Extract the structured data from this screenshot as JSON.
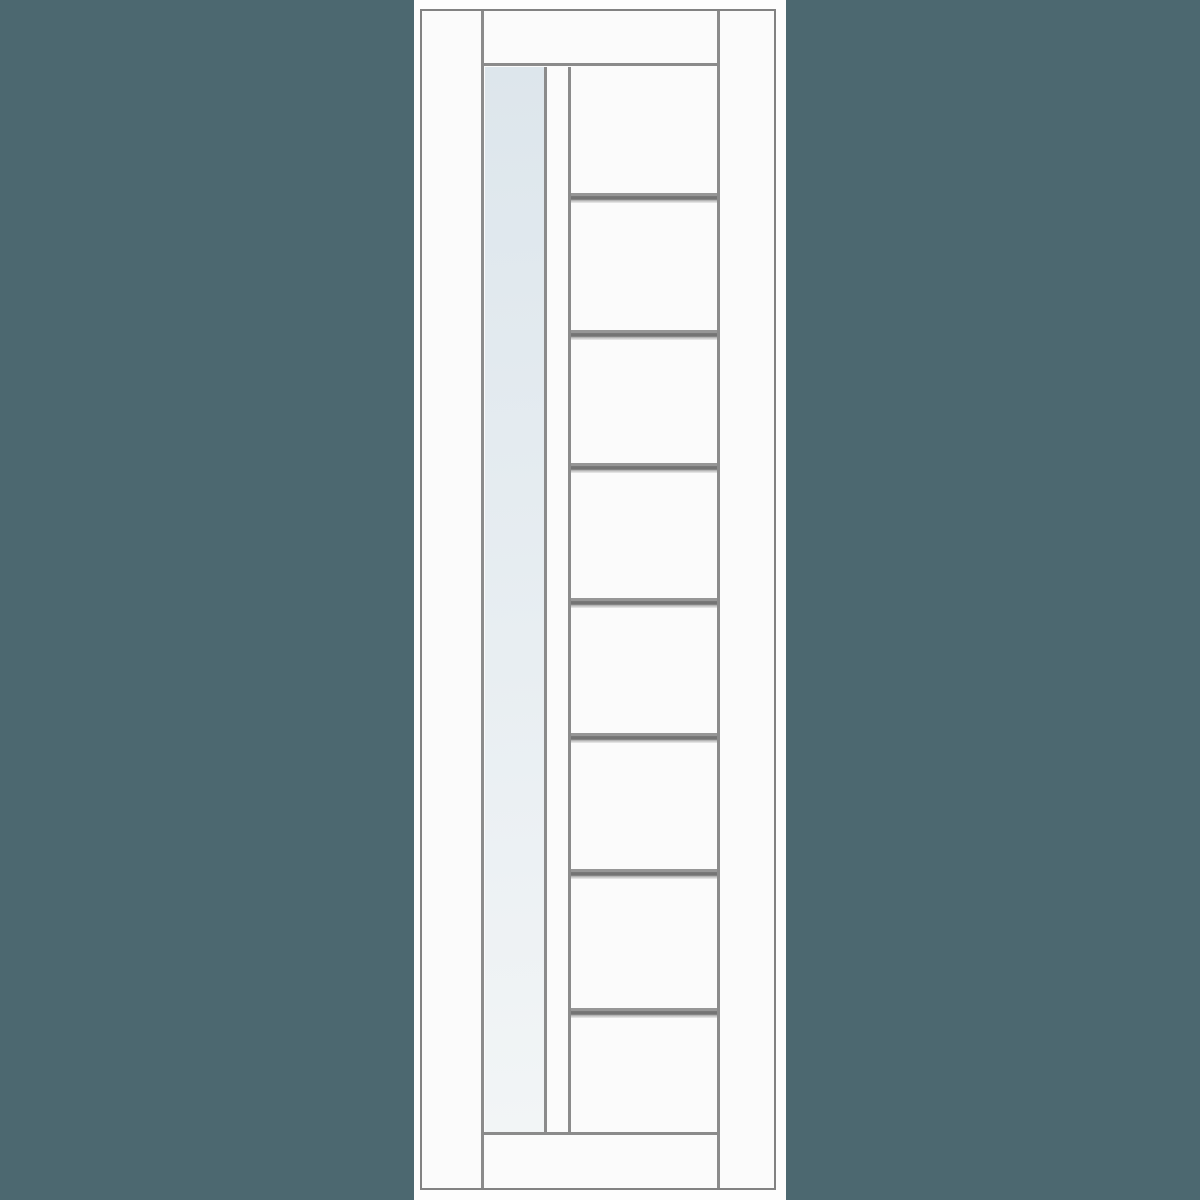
{
  "scene": {
    "type": "interior-door-product-illustration",
    "visible_text": []
  },
  "colors": {
    "background": "#4c6870",
    "strip": "#fdfdfd",
    "door_fill": "#fbfbfb",
    "line": "#8b8b8b",
    "line_dark": "#828282",
    "glass_top": "#dde6ec",
    "glass_mid": "#e8eef2",
    "glass_bottom": "#f2f5f6",
    "groove_top": "#969696",
    "groove_mid": "#747474",
    "groove_light": "#bdbdbd"
  },
  "door": {
    "glass_panel_count": 1,
    "groove_count": 7,
    "groove_height_px": 10,
    "groove_offsets_px": [
      126,
      263,
      396,
      531,
      666,
      802,
      941
    ]
  }
}
